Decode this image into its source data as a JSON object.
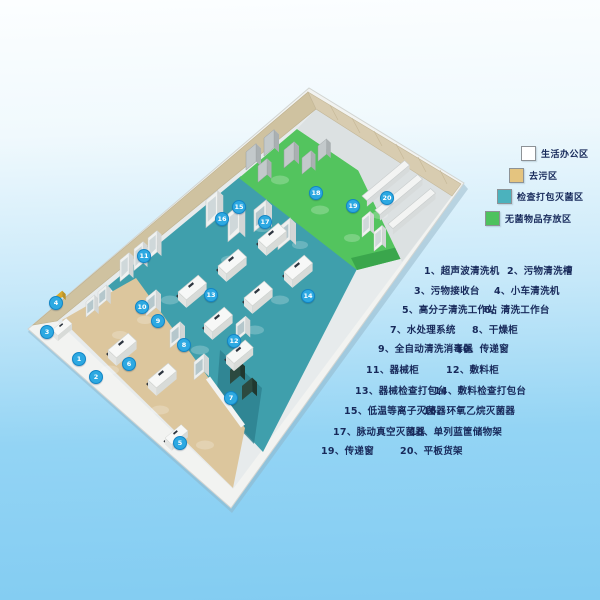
{
  "legend": {
    "items": [
      {
        "label": "生活办公区",
        "color": "#ffffff"
      },
      {
        "label": "去污区",
        "color": "#e4c47f"
      },
      {
        "label": "检查打包灭菌区",
        "color": "#4bb2bd"
      },
      {
        "label": "无菌物品存放区",
        "color": "#4ec25e"
      }
    ]
  },
  "equipment_list": {
    "items": [
      "1、超声波清洗机",
      "2、污物清洗槽",
      "3、污物接收台",
      "4、小车清洗机",
      "5、高分子清洗工作站",
      "6、清洗工作台",
      "7、水处理系统",
      "8、干燥柜",
      "9、全自动清洗消毒器",
      "10、传递窗",
      "11、器械柜",
      "12、敷料柜",
      "13、器械检查打包台",
      "14、敷料检查打包台",
      "15、低温等离子灭菌器",
      "16、环氧乙烷灭菌器",
      "17、脉动真空灭菌器",
      "18、单列蓝筐储物架",
      "19、传递窗",
      "20、平板货架"
    ]
  },
  "plan": {
    "marker_color": "#2da9e2",
    "markers": [
      "1",
      "2",
      "3",
      "4",
      "5",
      "6",
      "7",
      "8",
      "9",
      "10",
      "11",
      "12",
      "13",
      "14",
      "15",
      "16",
      "17",
      "18",
      "19",
      "20"
    ],
    "zone_colors": {
      "office_white": "#ffffff",
      "decontamination_tan": "#dcc69d",
      "inspection_sterilization_teal": "#3f9fac",
      "sterile_storage_green": "#53c45e",
      "wall_tan": "#cfc2a0",
      "wall_tan_light": "#d8ccb0",
      "base_rim": "#f2f3f1",
      "floor_base": "#e7ebec",
      "rack_strip": "#dce1e2"
    }
  }
}
